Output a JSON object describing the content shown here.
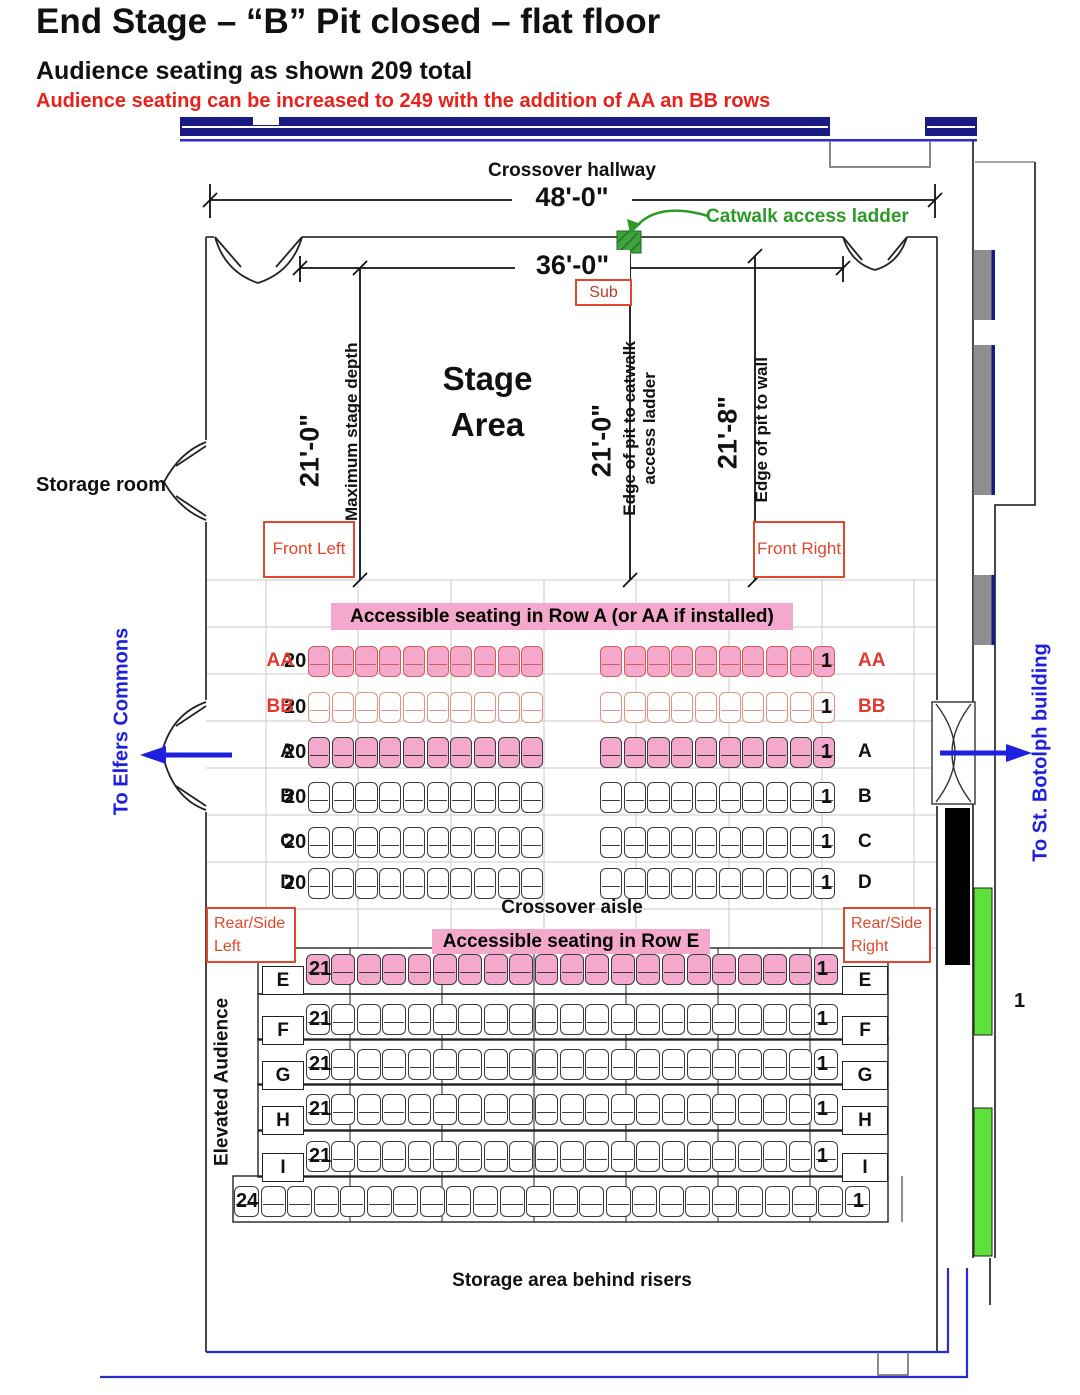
{
  "header": {
    "title": "End Stage – “B” Pit closed – flat floor",
    "subtitle": "Audience seating as shown 209 total",
    "note": "Audience seating can be increased to 249 with the addition of AA an BB rows"
  },
  "hallway": {
    "label": "Crossover hallway",
    "dim_48": "48'-0\"",
    "catwalk": "Catwalk access ladder",
    "dim_36": "36'-0\"",
    "sub": "Sub"
  },
  "stage": {
    "area": "Stage Area",
    "dim_left": "21'-0\"",
    "max_depth": "Maximum stage depth",
    "dim_mid": "21'-0\"",
    "edge_catwalk": "Edge of pit to catwalk access ladder",
    "dim_right": "21'-8\"",
    "edge_wall": "Edge of pit to wall",
    "storage_room": "Storage room",
    "front_left": "Front Left",
    "front_right": "Front Right"
  },
  "audience": {
    "banner_a": "Accessible seating in Row A (or AA if installed)",
    "banner_e": "Accessible seating in Row E",
    "crossover_aisle": "Crossover aisle",
    "elevated": "Elevated Audience",
    "storage_behind": "Storage area behind risers",
    "right_marker": "1",
    "rear_left": {
      "line1": "Rear/Side",
      "line2": "Left"
    },
    "rear_right": {
      "line1": "Rear/Side",
      "line2": "Right"
    },
    "exits": {
      "elfers": "To Elfers Commons",
      "botolph": "To St. Botolph building"
    },
    "totals": {
      "as_shown": 209,
      "with_aa_bb": 249
    },
    "rows": [
      {
        "name": "AA",
        "left": "20",
        "right": "1",
        "count": 20,
        "layout": "split",
        "fill": "#F4A8CC",
        "stroke": "#D85A50",
        "labelColor": "#E0392E"
      },
      {
        "name": "BB",
        "left": "20",
        "right": "1",
        "count": 20,
        "layout": "split",
        "fill": "#FFFFFF",
        "stroke": "#E39182",
        "labelColor": "#E0392E"
      },
      {
        "name": "A",
        "left": "20",
        "right": "1",
        "count": 20,
        "layout": "split",
        "fill": "#F4A8CC",
        "stroke": "#3A3A3A",
        "labelColor": "#111111"
      },
      {
        "name": "B",
        "left": "20",
        "right": "1",
        "count": 20,
        "layout": "split",
        "fill": "#FFFFFF",
        "stroke": "#3A3A3A",
        "labelColor": "#111111"
      },
      {
        "name": "C",
        "left": "20",
        "right": "1",
        "count": 20,
        "layout": "split",
        "fill": "#FFFFFF",
        "stroke": "#3A3A3A",
        "labelColor": "#111111"
      },
      {
        "name": "D",
        "left": "20",
        "right": "1",
        "count": 20,
        "layout": "split",
        "fill": "#FFFFFF",
        "stroke": "#3A3A3A",
        "labelColor": "#111111"
      },
      {
        "name": "E",
        "left": "21",
        "right": "1",
        "count": 21,
        "layout": "full",
        "boxed": true,
        "fill": "#F4A8CC",
        "stroke": "#3A3A3A",
        "labelColor": "#111111"
      },
      {
        "name": "F",
        "left": "21",
        "right": "1",
        "count": 21,
        "layout": "full",
        "boxed": true,
        "fill": "#FFFFFF",
        "stroke": "#3A3A3A",
        "labelColor": "#111111"
      },
      {
        "name": "G",
        "left": "21",
        "right": "1",
        "count": 21,
        "layout": "full",
        "boxed": true,
        "fill": "#FFFFFF",
        "stroke": "#3A3A3A",
        "labelColor": "#111111"
      },
      {
        "name": "H",
        "left": "21",
        "right": "1",
        "count": 21,
        "layout": "full",
        "boxed": true,
        "fill": "#FFFFFF",
        "stroke": "#3A3A3A",
        "labelColor": "#111111"
      },
      {
        "name": "I",
        "left": "21",
        "right": "1",
        "count": 21,
        "layout": "full",
        "boxed": true,
        "fill": "#FFFFFF",
        "stroke": "#3A3A3A",
        "labelColor": "#111111"
      },
      {
        "name": "",
        "left": "24",
        "right": "1",
        "count": 24,
        "layout": "wide",
        "fill": "#FFFFFF",
        "stroke": "#3A3A3A",
        "labelColor": "#111111"
      }
    ]
  },
  "colors": {
    "accent_red": "#E0482C",
    "note_red": "#E8221B",
    "accessible_pink": "#F4A8CC",
    "navy_wall": "#1A1A85",
    "blue_exit": "#1F1FDF",
    "green_label": "#2E9929",
    "green_block": "#5FE13B",
    "gray_block": "#8E8E8E",
    "black_block": "#000000"
  }
}
